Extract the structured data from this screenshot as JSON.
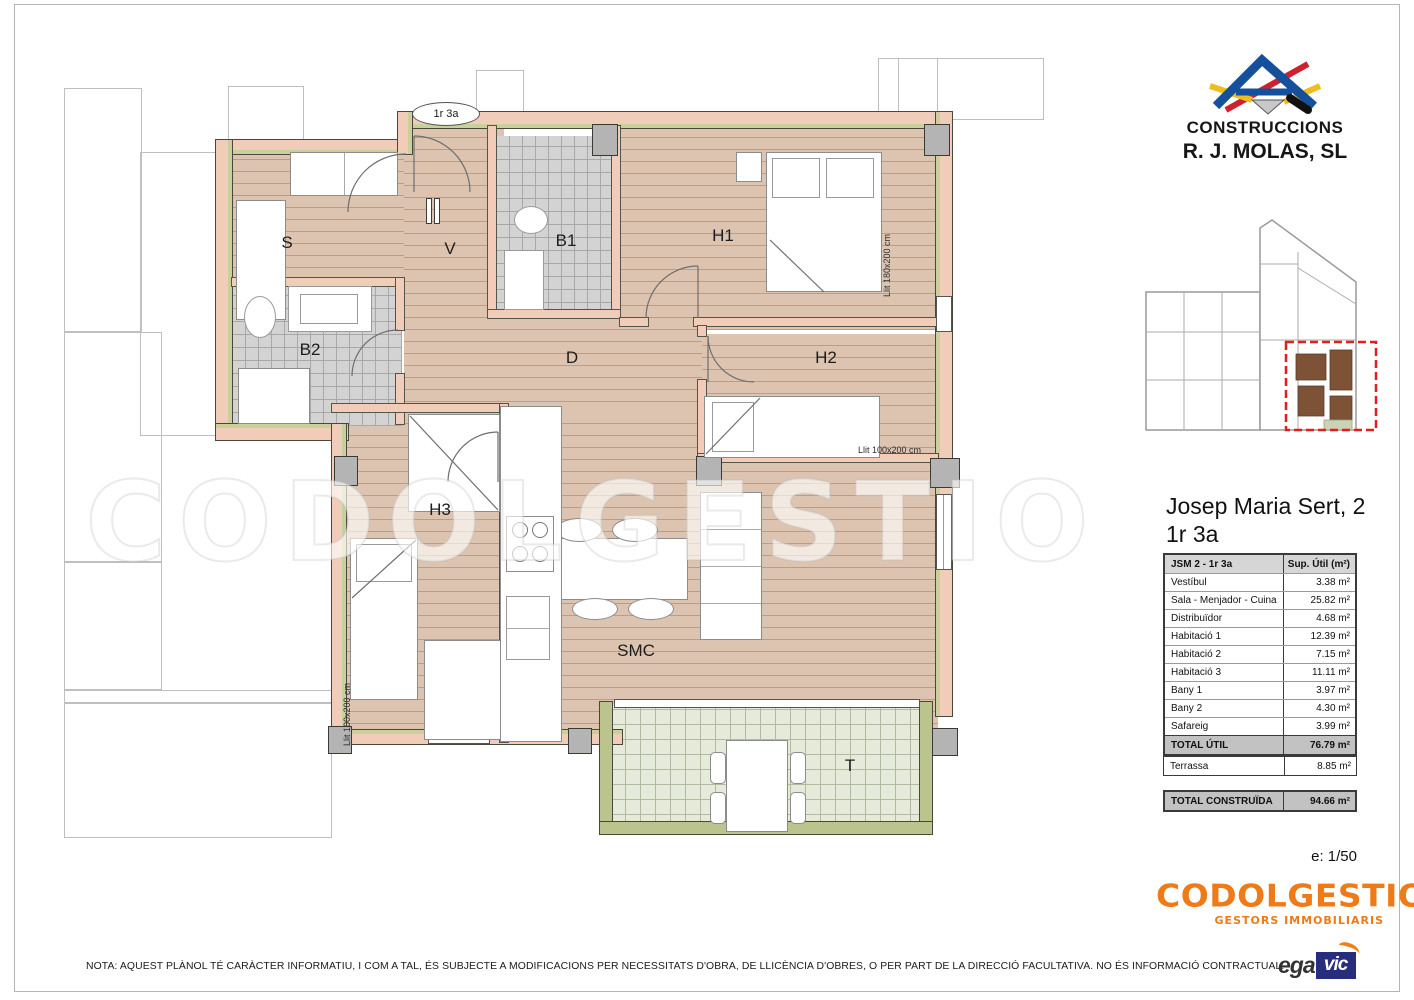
{
  "logo": {
    "line1": "CONSTRUCCIONS",
    "line2": "R. J. MOLAS, SL"
  },
  "unit_tag": "1r 3a",
  "title": {
    "line1": "Josep Maria Sert, 2",
    "line2": "1r 3a"
  },
  "area_table": {
    "header_name": "JSM 2 - 1r 3a",
    "header_value": "Sup. Útil (m²)",
    "rows": [
      {
        "name": "Vestíbul",
        "value": "3.38 m²"
      },
      {
        "name": "Sala - Menjador - Cuina",
        "value": "25.82 m²"
      },
      {
        "name": "Distribuïdor",
        "value": "4.68 m²"
      },
      {
        "name": "Habitació 1",
        "value": "12.39 m²"
      },
      {
        "name": "Habitació 2",
        "value": "7.15 m²"
      },
      {
        "name": "Habitació 3",
        "value": "11.11 m²"
      },
      {
        "name": "Bany 1",
        "value": "3.97 m²"
      },
      {
        "name": "Bany 2",
        "value": "4.30 m²"
      },
      {
        "name": "Safareig",
        "value": "3.99 m²"
      }
    ],
    "total_util_name": "TOTAL ÚTIL",
    "total_util_value": "76.79 m²",
    "terrassa_name": "Terrassa",
    "terrassa_value": "8.85 m²",
    "total_built_name": "TOTAL CONSTRUÏDA",
    "total_built_value": "94.66 m²"
  },
  "scale_label": "e: 1/50",
  "brand": {
    "name": "CODOLGESTIO",
    "tagline": "GESTORS IMMOBILIARIS",
    "color": "#ee7b18"
  },
  "egavic": {
    "left": "ega",
    "right": "vic"
  },
  "footer_note": "NOTA: AQUEST PLÀNOL TÉ CARÀCTER INFORMATIU, I COM A TAL, ÉS SUBJECTE A MODIFICACIONS PER NECESSITATS D'OBRA, DE LLICÈNCIA D'OBRES, O PER PART DE LA DIRECCIÓ FACULTATIVA.  NO ÉS INFORMACIÓ CONTRACTUAL.",
  "plan": {
    "watermark": "CODOLGESTIO",
    "rooms": [
      {
        "label": "S"
      },
      {
        "label": "V"
      },
      {
        "label": "B1"
      },
      {
        "label": "H1"
      },
      {
        "label": "B2"
      },
      {
        "label": "D"
      },
      {
        "label": "H2"
      },
      {
        "label": "H3"
      },
      {
        "label": "SMC"
      },
      {
        "label": "T"
      }
    ],
    "annotations": [
      {
        "text": "Llit 180x200 cm"
      },
      {
        "text": "Llit 100x200 cm"
      },
      {
        "text": "Llit 100x200 cm"
      }
    ]
  }
}
